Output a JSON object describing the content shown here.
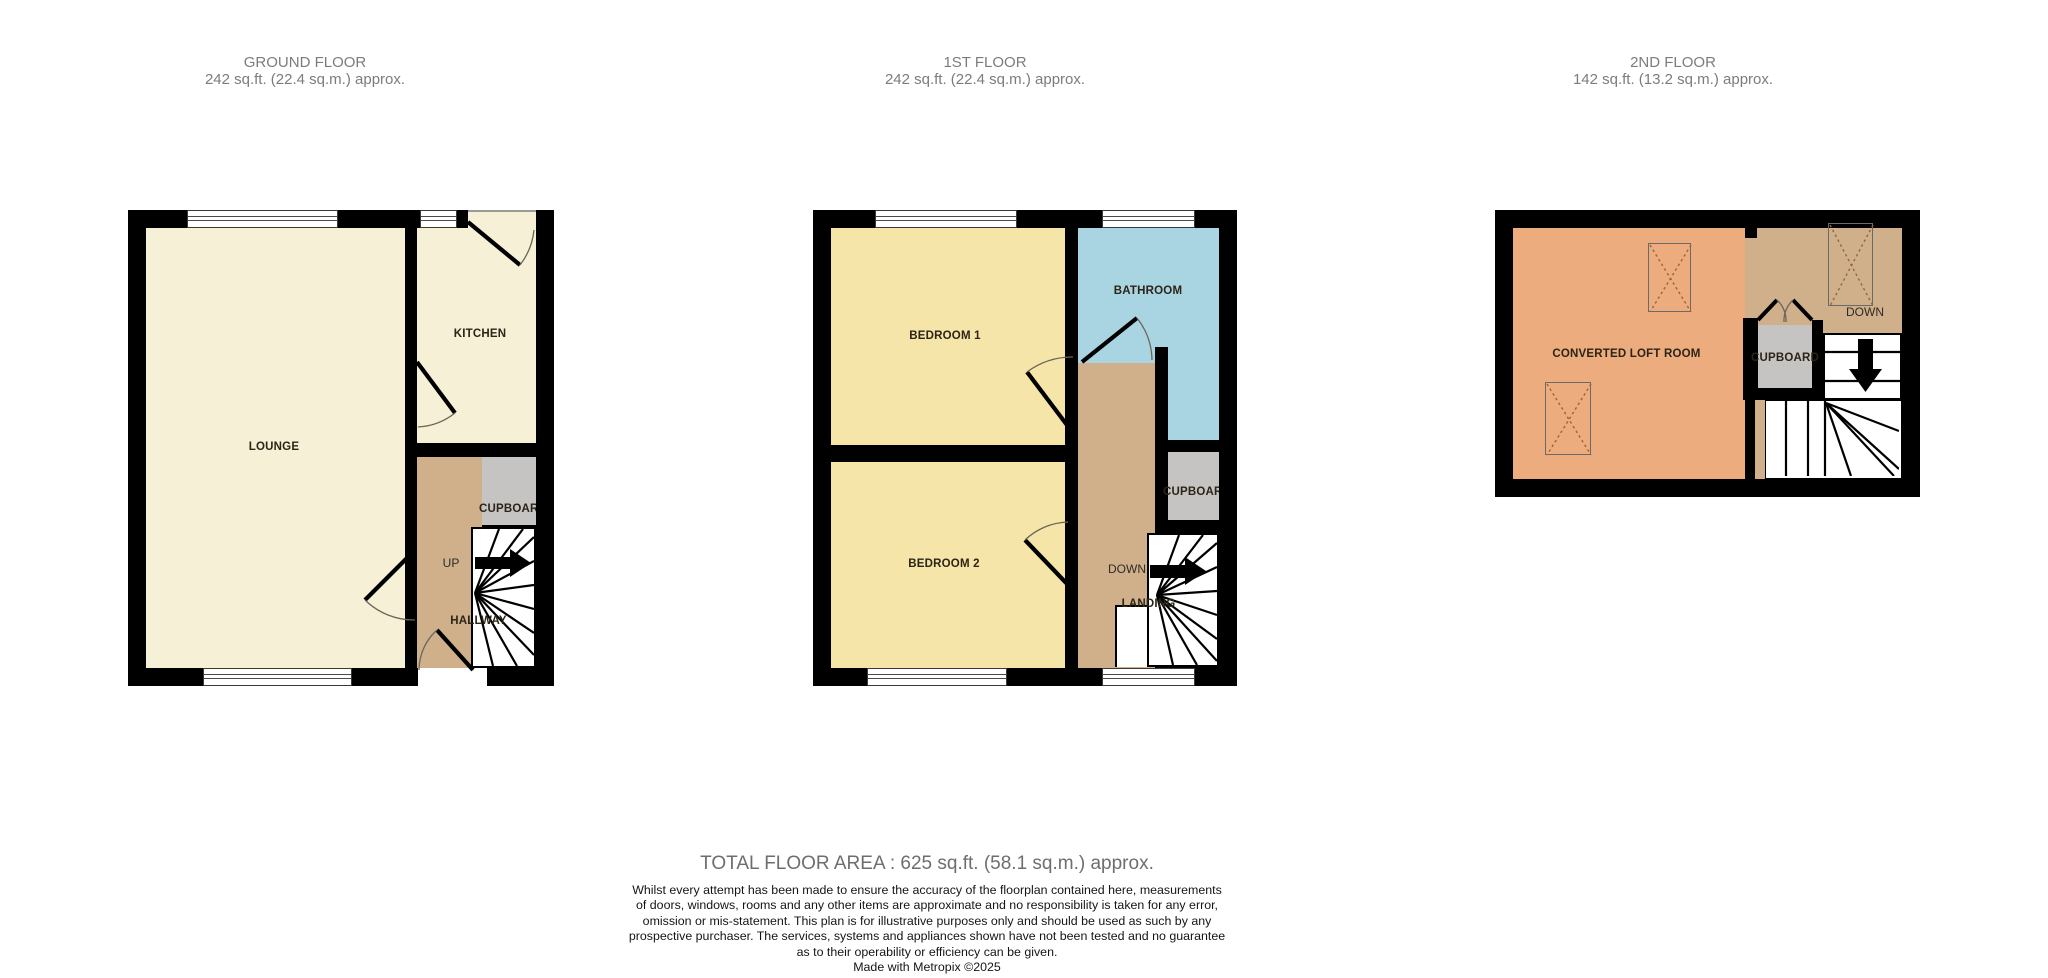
{
  "header": {
    "floors": [
      {
        "title": "GROUND FLOOR",
        "area": "242 sq.ft. (22.4 sq.m.) approx."
      },
      {
        "title": "1ST FLOOR",
        "area": "242 sq.ft. (22.4 sq.m.) approx."
      },
      {
        "title": "2ND FLOOR",
        "area": "142 sq.ft. (13.2 sq.m.) approx."
      }
    ]
  },
  "ground_floor": {
    "lounge": "LOUNGE",
    "kitchen": "KITCHEN",
    "cupboard": "CUPBOARD",
    "hallway": "HALLWAY",
    "up": "UP"
  },
  "first_floor": {
    "bedroom1": "BEDROOM 1",
    "bathroom": "BATHROOM",
    "bedroom2": "BEDROOM 2",
    "cupboard": "CUPBOARD",
    "landing": "LANDING",
    "down": "DOWN"
  },
  "second_floor": {
    "loft": "CONVERTED LOFT ROOM",
    "cupboard": "CUPBOARD",
    "down": "DOWN"
  },
  "footer": {
    "total": "TOTAL FLOOR AREA : 625 sq.ft. (58.1 sq.m.) approx.",
    "disclaimer": [
      "Whilst every attempt has been made to ensure the accuracy of the floorplan contained here, measurements",
      "of doors, windows, rooms and any other items are approximate and no responsibility is taken for any error,",
      "omission or mis-statement. This plan is for illustrative purposes only and should be used as such by any",
      "prospective purchaser. The services, systems and appliances shown have not been tested and no guarantee",
      "as to their operability or efficiency can be given."
    ],
    "made_with": "Made with Metropix ©2025"
  },
  "colors": {
    "wall": "#000000",
    "cream": "#F6F0D6",
    "yellow": "#F5E5A8",
    "blue": "#A9D5E2",
    "tan": "#CFB08B",
    "gray": "#C5C4C2",
    "orange": "#ECAC7D",
    "room_label": "#2B2417",
    "floor_title": "#7C7C7C",
    "total_text": "#6E6E6E",
    "disclaimer_text": "#151515"
  }
}
